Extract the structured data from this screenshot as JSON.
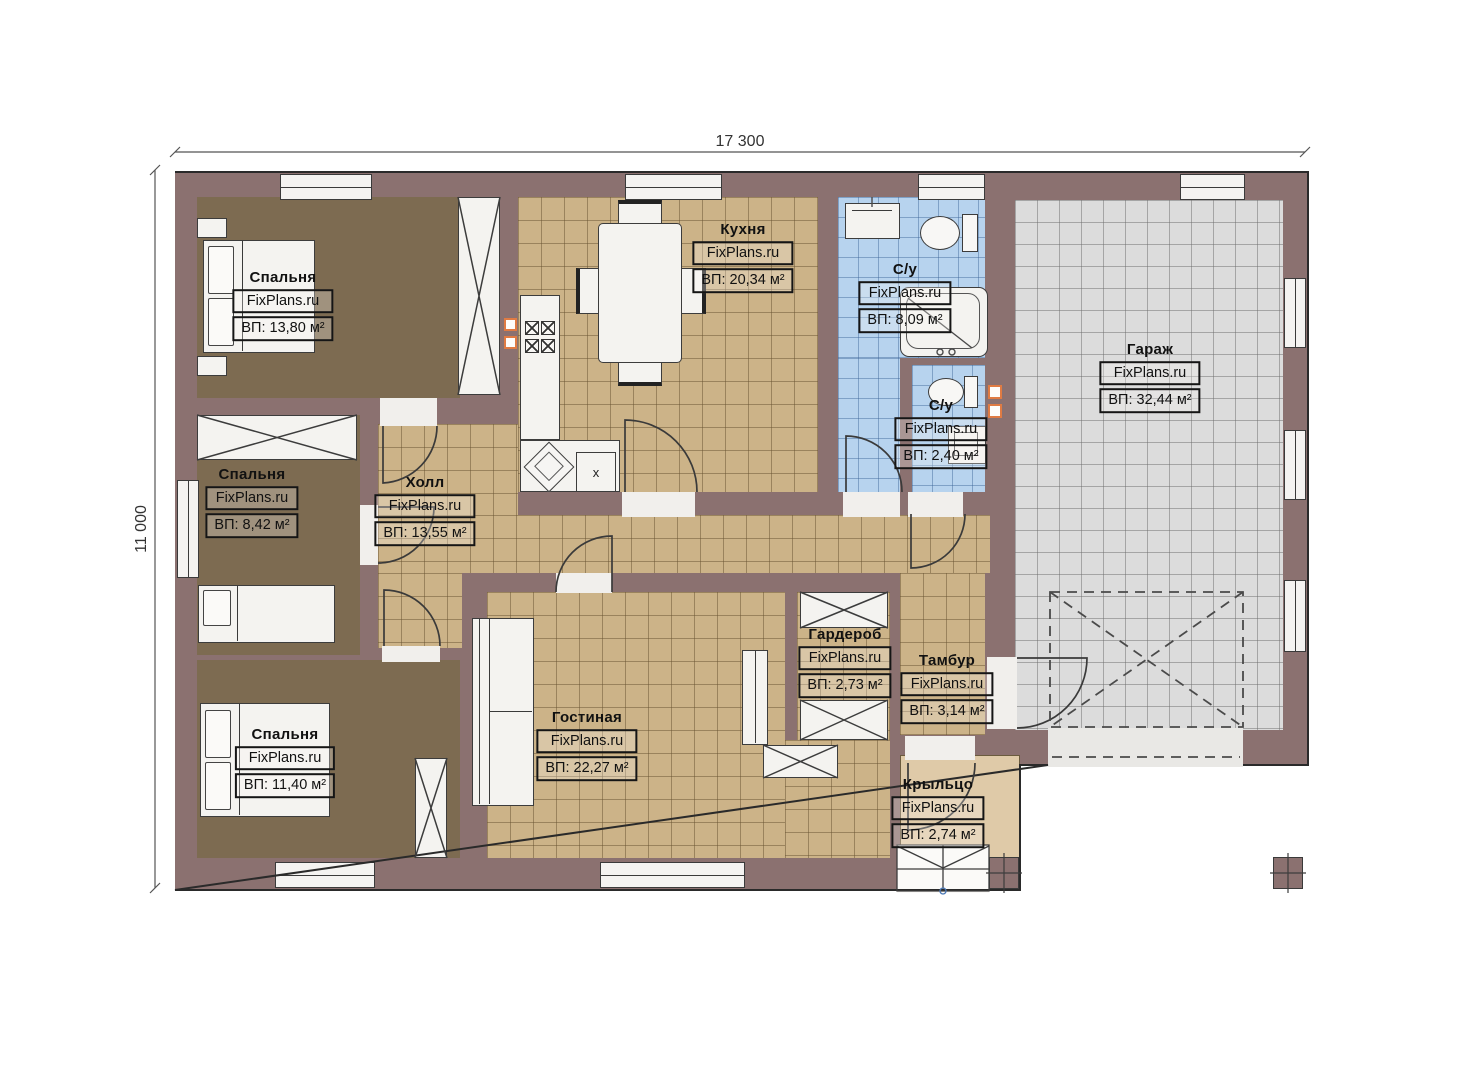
{
  "watermark": "FixPlans.ru",
  "dimensions": {
    "width": "17 300",
    "height": "11 000"
  },
  "rooms": [
    {
      "id": "bedroom1",
      "name": "Спальня",
      "area": "ВП: 13,80 м²"
    },
    {
      "id": "bedroom2",
      "name": "Спальня",
      "area": "ВП: 8,42 м²"
    },
    {
      "id": "bedroom3",
      "name": "Спальня",
      "area": "ВП: 11,40 м²"
    },
    {
      "id": "kitchen",
      "name": "Кухня",
      "area": "ВП: 20,34 м²"
    },
    {
      "id": "hall",
      "name": "Холл",
      "area": "ВП: 13,55 м²"
    },
    {
      "id": "bath1",
      "name": "С/у",
      "area": "ВП: 8,09 м²"
    },
    {
      "id": "bath2",
      "name": "С/у",
      "area": "ВП: 2,40 м²"
    },
    {
      "id": "garage",
      "name": "Гараж",
      "area": "ВП: 32,44 м²"
    },
    {
      "id": "living",
      "name": "Гостиная",
      "area": "ВП: 22,27 м²"
    },
    {
      "id": "wardrobe",
      "name": "Гардероб",
      "area": "ВП: 2,73 м²"
    },
    {
      "id": "tambur",
      "name": "Тамбур",
      "area": "ВП: 3,14 м²"
    },
    {
      "id": "porch",
      "name": "Крыльцо",
      "area": "ВП: 2,74 м²"
    }
  ],
  "kitchen_fixtures": {
    "appliance_label": "х"
  },
  "colors": {
    "wall": "#8b7170",
    "bedroom_floor": "#7d6b51",
    "tile_beige": "#ccb388",
    "tile_blue": "#b7d3ee",
    "tile_gray": "#dcdcdc",
    "porch": "#dfcaa8",
    "accent_orange": "#e07b43"
  }
}
